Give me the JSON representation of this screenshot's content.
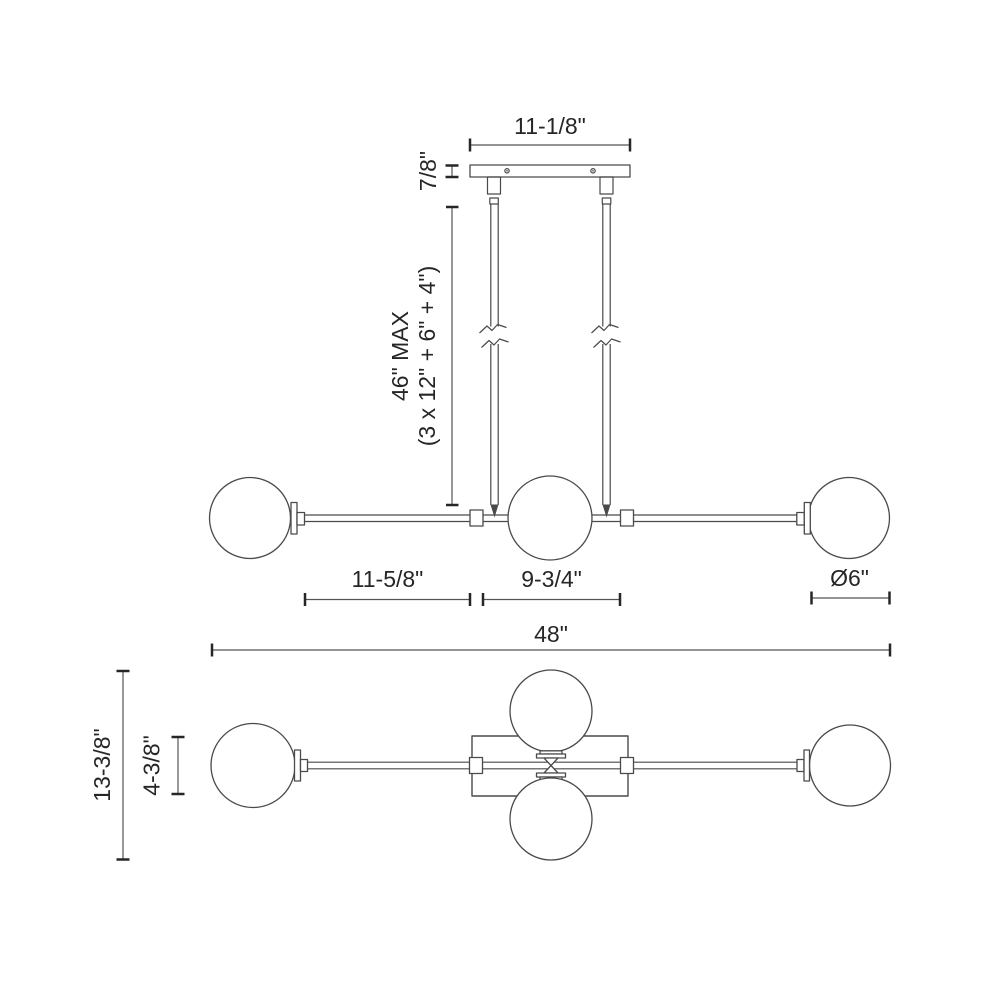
{
  "page": {
    "background": "#ffffff",
    "line_color": "#4a4a4a",
    "text_color": "#262626"
  },
  "drawing": {
    "front_view": {
      "canopy_width": "11-1/8\"",
      "canopy_height": "7/8\"",
      "suspension_max": "46\" MAX",
      "suspension_breakdown": "(3 x 12\" + 6\" + 4\")",
      "left_arm_length": "11-5/8\"",
      "center_section": "9-3/4\"",
      "globe_diameter": "Ø6\""
    },
    "overall": {
      "width": "48\""
    },
    "plan_view": {
      "overall_depth": "13-3/8\"",
      "body_depth": "4-3/8\""
    }
  }
}
